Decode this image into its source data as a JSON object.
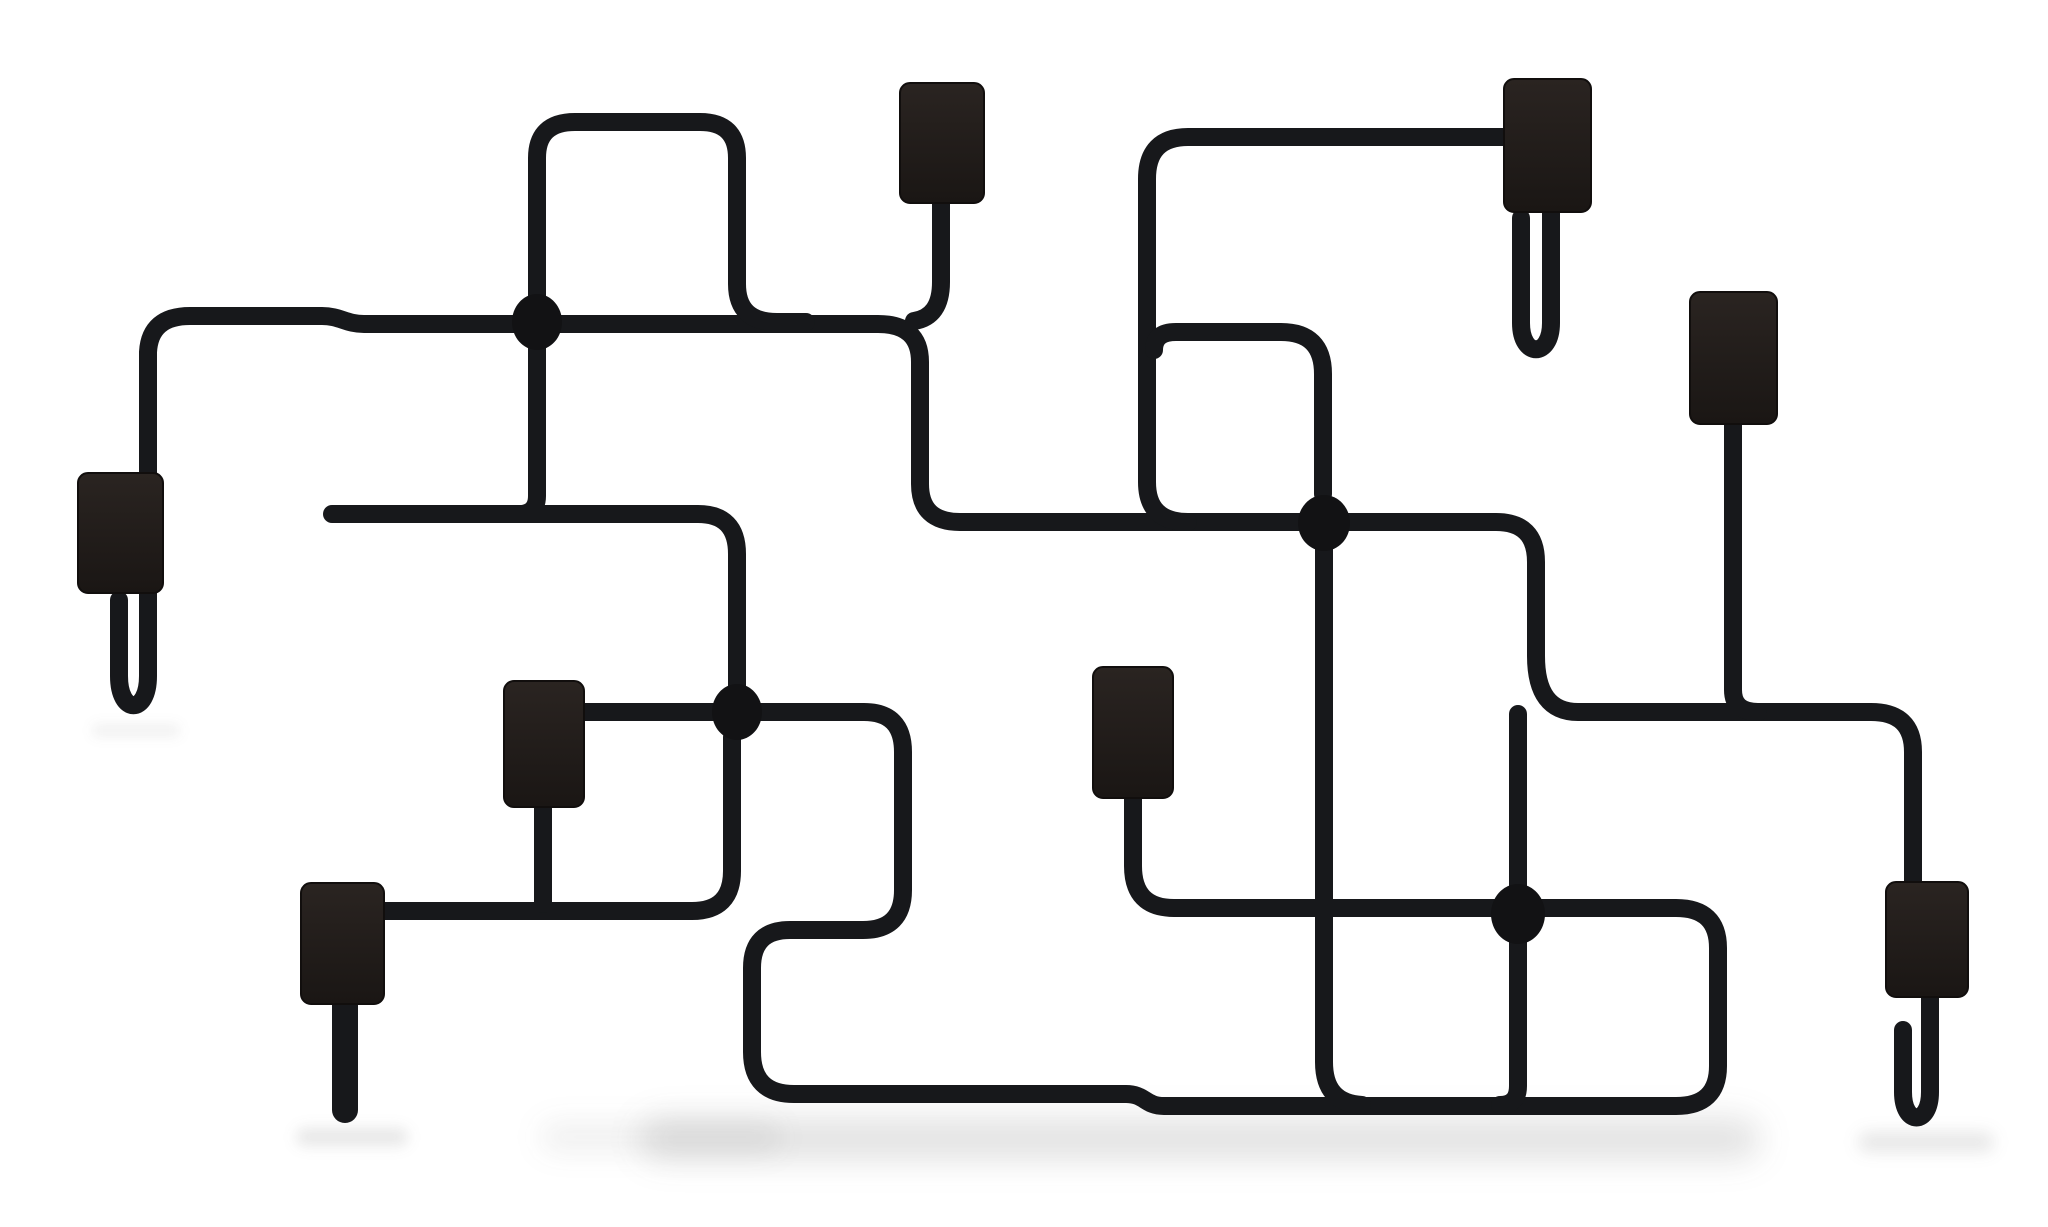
{
  "image": {
    "subject": "Black tubular metal wall-mounted coat rack shaped like an underground metro map, with eight dark wooden hook pads, four oval junction nodes and J-shaped hanger hooks, photographed on a plain white background",
    "background_color": "#ffffff",
    "width": 2048,
    "height": 1227
  },
  "art": {
    "wire_color": "#17181b",
    "wire_width": 18,
    "dot_color": "#121214",
    "pad_stroke": "#110e0d",
    "pad_radius": 10,
    "pad_gradient": [
      "#2a2421",
      "#1a1614"
    ],
    "shadow_color": "#3a3a3a",
    "wires": [
      {
        "name": "wire-left-hook-main-run",
        "d": "M 119 600 V 676 C 119 715 148 715 148 676 V 352 Q 150 316 190 316 H 322 C 340 316 346 324 364 324 H 878 Q 920 324 920 362 V 484 Q 920 522 960 522 H 1496 Q 1536 522 1536 562 V 656 Q 1536 712 1578 712 H 1871 Q 1913 712 1913 752 V 884",
        "w": 18
      },
      {
        "name": "wire-top-left-loop",
        "d": "M 522 514 Q 537 512 537 496 V 158 Q 537 122 575 122 H 700 Q 737 122 737 158 V 284 Q 737 322 777 322 H 806",
        "w": 18
      },
      {
        "name": "wire-pad-a-drop",
        "d": "M 941 202 V 282 Q 941 317 914 321",
        "w": 18
      },
      {
        "name": "wire-free-end-to-junction-3",
        "d": "M 332 514 H 698 Q 737 514 737 554 V 692",
        "w": 18
      },
      {
        "name": "wire-square-loop-bottom-left",
        "d": "M 584 712 H 864 Q 903 712 903 752 V 890 Q 903 930 863 930 H 790 Q 752 930 752 968 V 1052 Q 752 1094 794 1094 H 1126 C 1145 1094 1145 1106 1164 1106 H 1676 Q 1718 1106 1718 1066 V 948 Q 1718 908 1676 908 H 1174 Q 1133 908 1133 866 V 798",
        "w": 18
      },
      {
        "name": "wire-pad-f-line-riser",
        "d": "M 383 911 H 692 Q 732 911 732 871 V 737",
        "w": 18
      },
      {
        "name": "wire-pad-e-drop",
        "d": "M 543 807 V 904",
        "w": 18
      },
      {
        "name": "wire-pad-f-prong",
        "d": "M 345 1003 V 1110",
        "w": 26
      },
      {
        "name": "wire-pad-b-run",
        "d": "M 1504 137 H 1188 Q 1147 137 1147 179 V 482 Q 1147 522 1188 522",
        "w": 18
      },
      {
        "name": "wire-square-loop-top-right",
        "d": "M 1154 350 Q 1154 332 1176 332 H 1281 Q 1323 332 1323 374 V 494",
        "w": 18
      },
      {
        "name": "wire-pad-b-hook",
        "d": "M 1551 212 V 323 C 1551 358 1521 358 1521 323 V 218",
        "w": 18
      },
      {
        "name": "wire-pad-c-drop",
        "d": "M 1733 424 V 690 Q 1733 712 1758 712",
        "w": 18
      },
      {
        "name": "wire-junction-2-drop",
        "d": "M 1324 544 V 1062 Q 1324 1103 1362 1105",
        "w": 18
      },
      {
        "name": "wire-junction-4-riser",
        "d": "M 1518 714 V 1086 Q 1518 1105 1500 1105",
        "w": 18
      },
      {
        "name": "wire-pad-h-hook",
        "d": "M 1930 997 V 1092 C 1930 1126 1903 1126 1903 1092 V 1030",
        "w": 18
      }
    ],
    "pads": [
      {
        "name": "hook-pad-top-left",
        "x": 900,
        "y": 83,
        "w": 84,
        "h": 120
      },
      {
        "name": "hook-pad-top-middle",
        "x": 1504,
        "y": 79,
        "w": 87,
        "h": 133
      },
      {
        "name": "hook-pad-right-upper",
        "x": 1690,
        "y": 292,
        "w": 87,
        "h": 132
      },
      {
        "name": "hook-pad-left",
        "x": 78,
        "y": 473,
        "w": 85,
        "h": 120
      },
      {
        "name": "hook-pad-middle-left",
        "x": 504,
        "y": 681,
        "w": 80,
        "h": 126
      },
      {
        "name": "hook-pad-middle-right",
        "x": 1093,
        "y": 667,
        "w": 80,
        "h": 131
      },
      {
        "name": "hook-pad-bottom-left",
        "x": 301,
        "y": 883,
        "w": 83,
        "h": 121
      },
      {
        "name": "hook-pad-bottom-right",
        "x": 1886,
        "y": 882,
        "w": 82,
        "h": 115
      }
    ],
    "dots": [
      {
        "name": "junction-dot-1",
        "cx": 537,
        "cy": 322,
        "rx": 25,
        "ry": 28
      },
      {
        "name": "junction-dot-2",
        "cx": 1324,
        "cy": 523,
        "rx": 26,
        "ry": 28
      },
      {
        "name": "junction-dot-3",
        "cx": 737,
        "cy": 712,
        "rx": 25,
        "ry": 28
      },
      {
        "name": "junction-dot-4",
        "cx": 1518,
        "cy": 914,
        "rx": 27,
        "ry": 30
      }
    ],
    "shadows": [
      {
        "name": "floor-shadow-main",
        "x": 640,
        "y": 1118,
        "w": 1120,
        "h": 42,
        "rx": 21,
        "blur": 16,
        "opacity": 0.15
      },
      {
        "name": "floor-shadow-left-edge",
        "x": 540,
        "y": 1122,
        "w": 240,
        "h": 30,
        "rx": 15,
        "blur": 14,
        "opacity": 0.08
      },
      {
        "name": "prong-shadow",
        "x": 296,
        "y": 1128,
        "w": 112,
        "h": 18,
        "rx": 9,
        "blur": 7,
        "opacity": 0.12
      },
      {
        "name": "hook-h-shadow",
        "x": 1858,
        "y": 1132,
        "w": 136,
        "h": 20,
        "rx": 10,
        "blur": 8,
        "opacity": 0.12
      },
      {
        "name": "hook-d-shadow",
        "x": 92,
        "y": 724,
        "w": 88,
        "h": 13,
        "rx": 6,
        "blur": 6,
        "opacity": 0.07
      }
    ]
  }
}
